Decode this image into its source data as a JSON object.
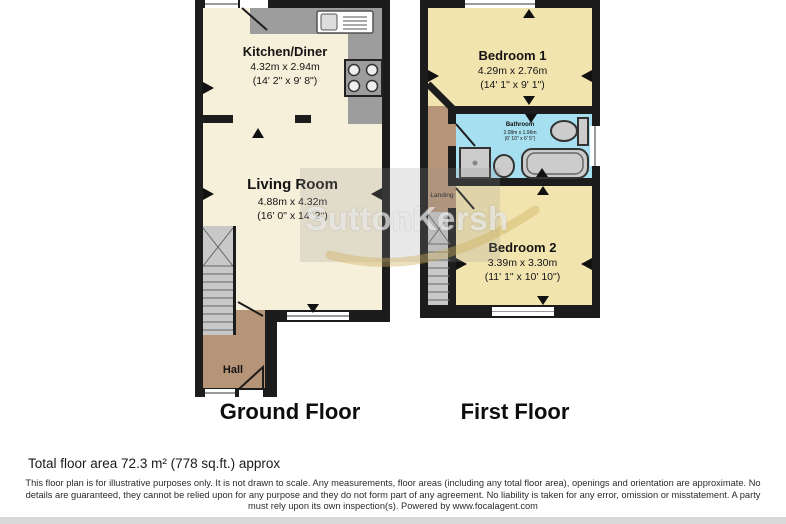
{
  "watermark": {
    "text": "SuttonKersh"
  },
  "ground_floor": {
    "label": "Ground Floor",
    "kitchen": {
      "name": "Kitchen/Diner",
      "metric": "4.32m x 2.94m",
      "imperial": "(14' 2\" x 9' 8\")"
    },
    "living_room": {
      "name": "Living Room",
      "metric": "4.88m x 4.32m",
      "imperial": "(16' 0\" x 14' 2\")"
    },
    "hall": {
      "name": "Hall"
    }
  },
  "first_floor": {
    "label": "First Floor",
    "bedroom1": {
      "name": "Bedroom 1",
      "metric": "4.29m x 2.76m",
      "imperial": "(14' 1\" x 9' 1\")"
    },
    "bathroom": {
      "name": "Bathroom",
      "metric": "2.08m x 1.96m",
      "imperial": "(6' 10\" x 6' 5\")"
    },
    "bedroom2": {
      "name": "Bedroom 2",
      "metric": "3.39m x 3.30m",
      "imperial": "(11' 1\" x 10' 10\")"
    },
    "landing": {
      "name": "Landing"
    }
  },
  "footer": {
    "total_area": "Total floor area 72.3 m² (778 sq.ft.) approx",
    "disclaimer": [
      "This floor plan is for illustrative purposes only. It is not drawn to scale. Any measurements, floor areas (including any total floor area), openings and orientation are approximate. No",
      "details are guaranteed, they cannot be relied upon for any purpose and they do not form part of any agreement. No liability is taken for any error, omission or misstatement. A party",
      "must rely upon its own inspection(s). Powered by www.focalagent.com"
    ]
  },
  "colors": {
    "room_cream": "#F6EFD9",
    "room_yellow": "#F2E4AF",
    "bathroom_blue": "#A6DFEF",
    "hall_brown": "#B69478",
    "wall_black": "#1C1C1C",
    "counter_gray": "#9D9D9D",
    "stairs_gray": "#C8C8C8"
  }
}
